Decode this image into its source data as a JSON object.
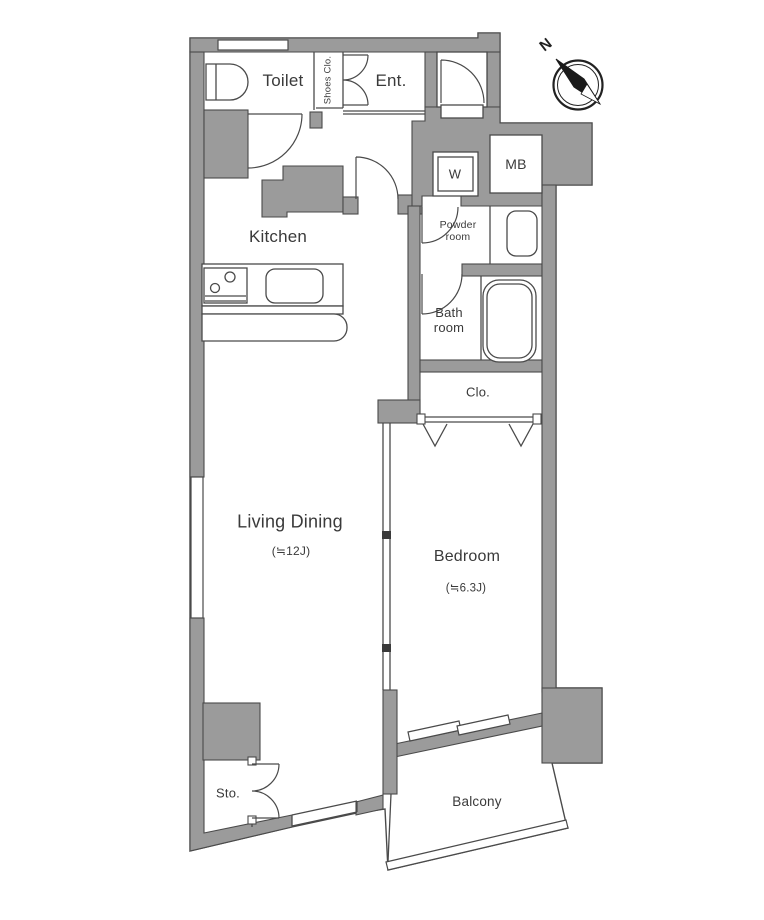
{
  "labels": {
    "toilet": "Toilet",
    "shoes_closet": "Shoes Clo.",
    "entrance": "Ent.",
    "washing_machine": "W",
    "meter_box": "MB",
    "powder_room": "Powder\nroom",
    "kitchen": "Kitchen",
    "bathroom": "Bath\nroom",
    "closet": "Clo.",
    "living_dining": "Living Dining",
    "living_dining_size": "(≒12J)",
    "bedroom": "Bedroom",
    "bedroom_size": "(≒6.3J)",
    "storage": "Sto.",
    "balcony": "Balcony",
    "compass_north": "N"
  },
  "colors": {
    "wall_fill": "#9b9b9b",
    "outline": "#4a4a4a",
    "text": "#3a3a3a",
    "room_fill": "#ffffff",
    "compass_needle": "#1a1a1a"
  }
}
